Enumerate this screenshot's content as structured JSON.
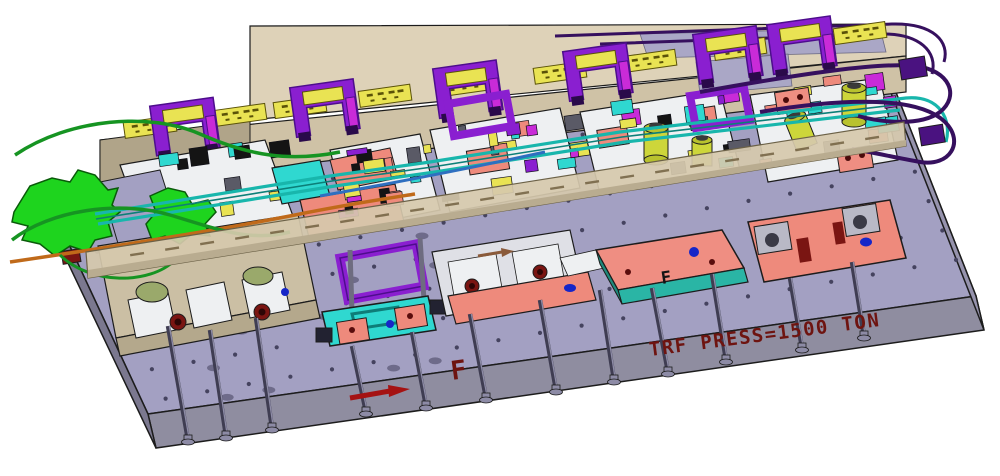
{
  "annotations": {
    "press_label": "TRF PRESS=1500 TON",
    "front_marker": "F",
    "plate_marker": "F"
  },
  "colors": {
    "outline": "#1c1c1c",
    "plate_top": "#a3a0c2",
    "plate_front": "#8f8da0",
    "plate_left": "#7b788f",
    "plate_right": "#9693ad",
    "hole_dot": "#45435f",
    "hole_oval": "#6e6b8a",
    "rail_top": "#ded2b8",
    "rail_front": "#cfc2a6",
    "rail_dark": "#b0a489",
    "rail_panel": "#aaa7c6",
    "beam_tan": "#d6c9ac",
    "beam_tan_dark": "#b9ac90",
    "tag_yellow": "#e9e353",
    "tag_dark": "#5a5208",
    "clamp_purple": "#8a1fd0",
    "clamp_purple_dark": "#4d0e8c",
    "clamp_magenta": "#c92bd8",
    "part_white": "#eef0f2",
    "part_gray": "#b9b9c6",
    "part_salmon": "#ee8a7c",
    "plate_pink": "#ef8e82",
    "edge_teal": "#2ab5a5",
    "part_cyan": "#2fd8d0",
    "blob_green": "#1ed41e",
    "tube_green": "#169422",
    "tube_teal": "#18b6ac",
    "tube_orange": "#c06a1a",
    "tube_blue": "#2e6fc0",
    "hose_purple": "#36105e",
    "cyl_yellow": "#cdd63a",
    "cyl_yellow_dark": "#b8c22e",
    "olive": "#9aa96b",
    "maroon": "#7a1512",
    "label_red": "#6e1410",
    "arrow_red": "#a51212",
    "dot_blue": "#1626c8",
    "rod_gray": "#3f3d52",
    "rod_light": "#8d8ba6",
    "shoe_tan": "#cbbfa4",
    "shoe_tan_dark": "#b4a88c"
  },
  "counts": {
    "stations": 5,
    "rail_tags": 9,
    "rail_clamps": 6,
    "guide_rods": 12,
    "hole_rows": 7,
    "hole_cols": 20
  }
}
